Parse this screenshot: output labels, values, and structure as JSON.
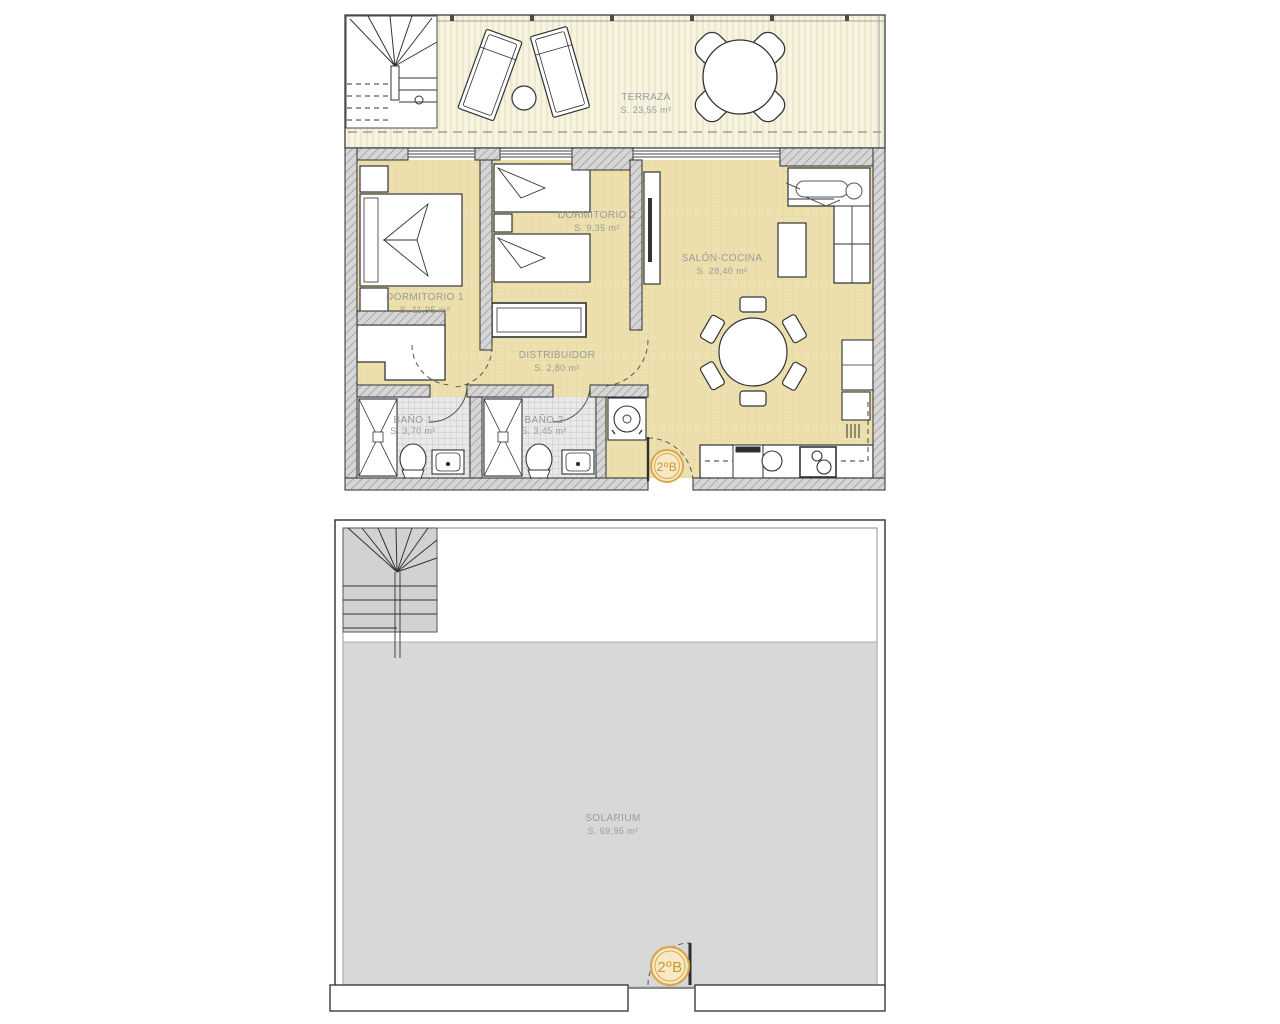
{
  "page": {
    "title": "Floor plan 2ºB",
    "background": "#ffffff"
  },
  "colors": {
    "apartment_floor": "#ece0ae",
    "terrace_floor": "#f6f3e1",
    "solarium_floor": "#d8d8d8",
    "wall_fill": "#d6d6d6",
    "outline": "#2e2e2e",
    "label_text": "#9b9b9b",
    "badge_ring": "#d9a84e",
    "badge_fill": "#f7e9c4",
    "badge_text": "#c9992f"
  },
  "upper_plan": {
    "name": "apartment-floor-plan",
    "unit_badge": "2ºB",
    "rooms": [
      {
        "id": "terraza",
        "name": "TERRAZA",
        "area": "S. 23,55 m²"
      },
      {
        "id": "dormitorio-1",
        "name": "DORMITORIO 1",
        "area": "S. 11,95 m²"
      },
      {
        "id": "dormitorio-2",
        "name": "DORMITORIO 2",
        "area": "S. 9,35 m²"
      },
      {
        "id": "salon-cocina",
        "name": "SALÓN-COCINA",
        "area": "S. 28,40 m²"
      },
      {
        "id": "distribuidor",
        "name": "DISTRIBUIDOR",
        "area": "S. 2,80 m²"
      },
      {
        "id": "bano-1",
        "name": "BAÑO 1",
        "area": "S. 3,70 m²"
      },
      {
        "id": "bano-2",
        "name": "BAÑO 2",
        "area": "S. 3,45 m²"
      }
    ]
  },
  "lower_plan": {
    "name": "solarium-floor-plan",
    "unit_badge": "2ºB",
    "rooms": [
      {
        "id": "solarium",
        "name": "SOLARIUM",
        "area": "S. 69,95 m²"
      }
    ]
  }
}
